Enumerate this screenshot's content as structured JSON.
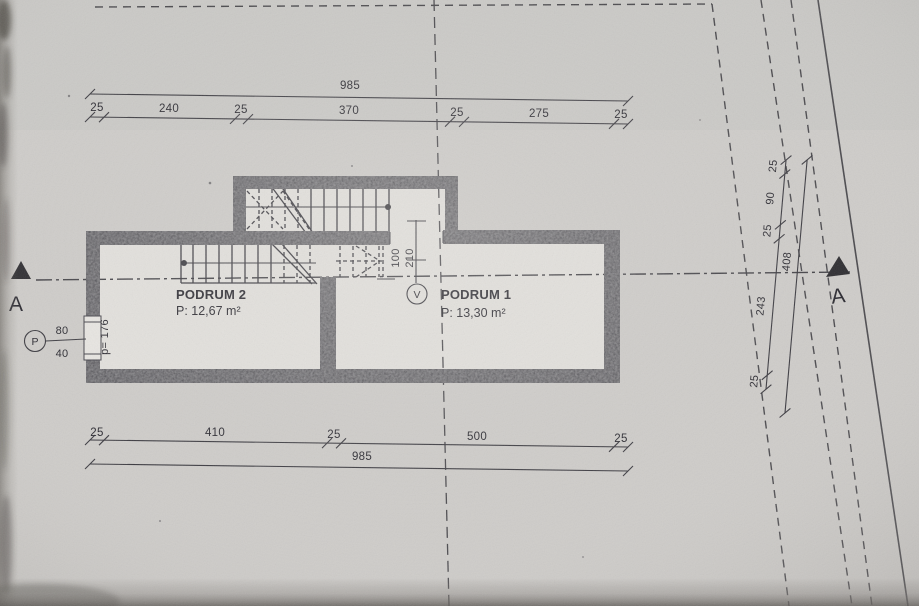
{
  "drawing": {
    "rooms": [
      {
        "name": "PODRUM 2",
        "area": "P: 12,67 m²"
      },
      {
        "name": "PODRUM 1",
        "area": "P: 13,30 m²"
      }
    ],
    "markers": {
      "section_left": "A",
      "section_right": "A",
      "door_circle": "V",
      "window_circle": "P"
    },
    "dimensions": {
      "top": {
        "total": "985",
        "segments": [
          "25",
          "240",
          "25",
          "370",
          "25",
          "275",
          "25"
        ]
      },
      "bottom": {
        "total": "985",
        "segments": [
          "25",
          "410",
          "25",
          "500",
          "25"
        ]
      },
      "right": {
        "total": "408",
        "segments": [
          "25",
          "90",
          "25",
          "243",
          "25"
        ]
      },
      "door": {
        "width": "100",
        "height": "210"
      },
      "window": {
        "above": "80",
        "below": "40",
        "parapet": "p= 176"
      }
    },
    "colors": {
      "paper": "#cfcdca",
      "wall": "#45444a",
      "ink": "#3b3a40",
      "text": "#2a2930"
    }
  }
}
